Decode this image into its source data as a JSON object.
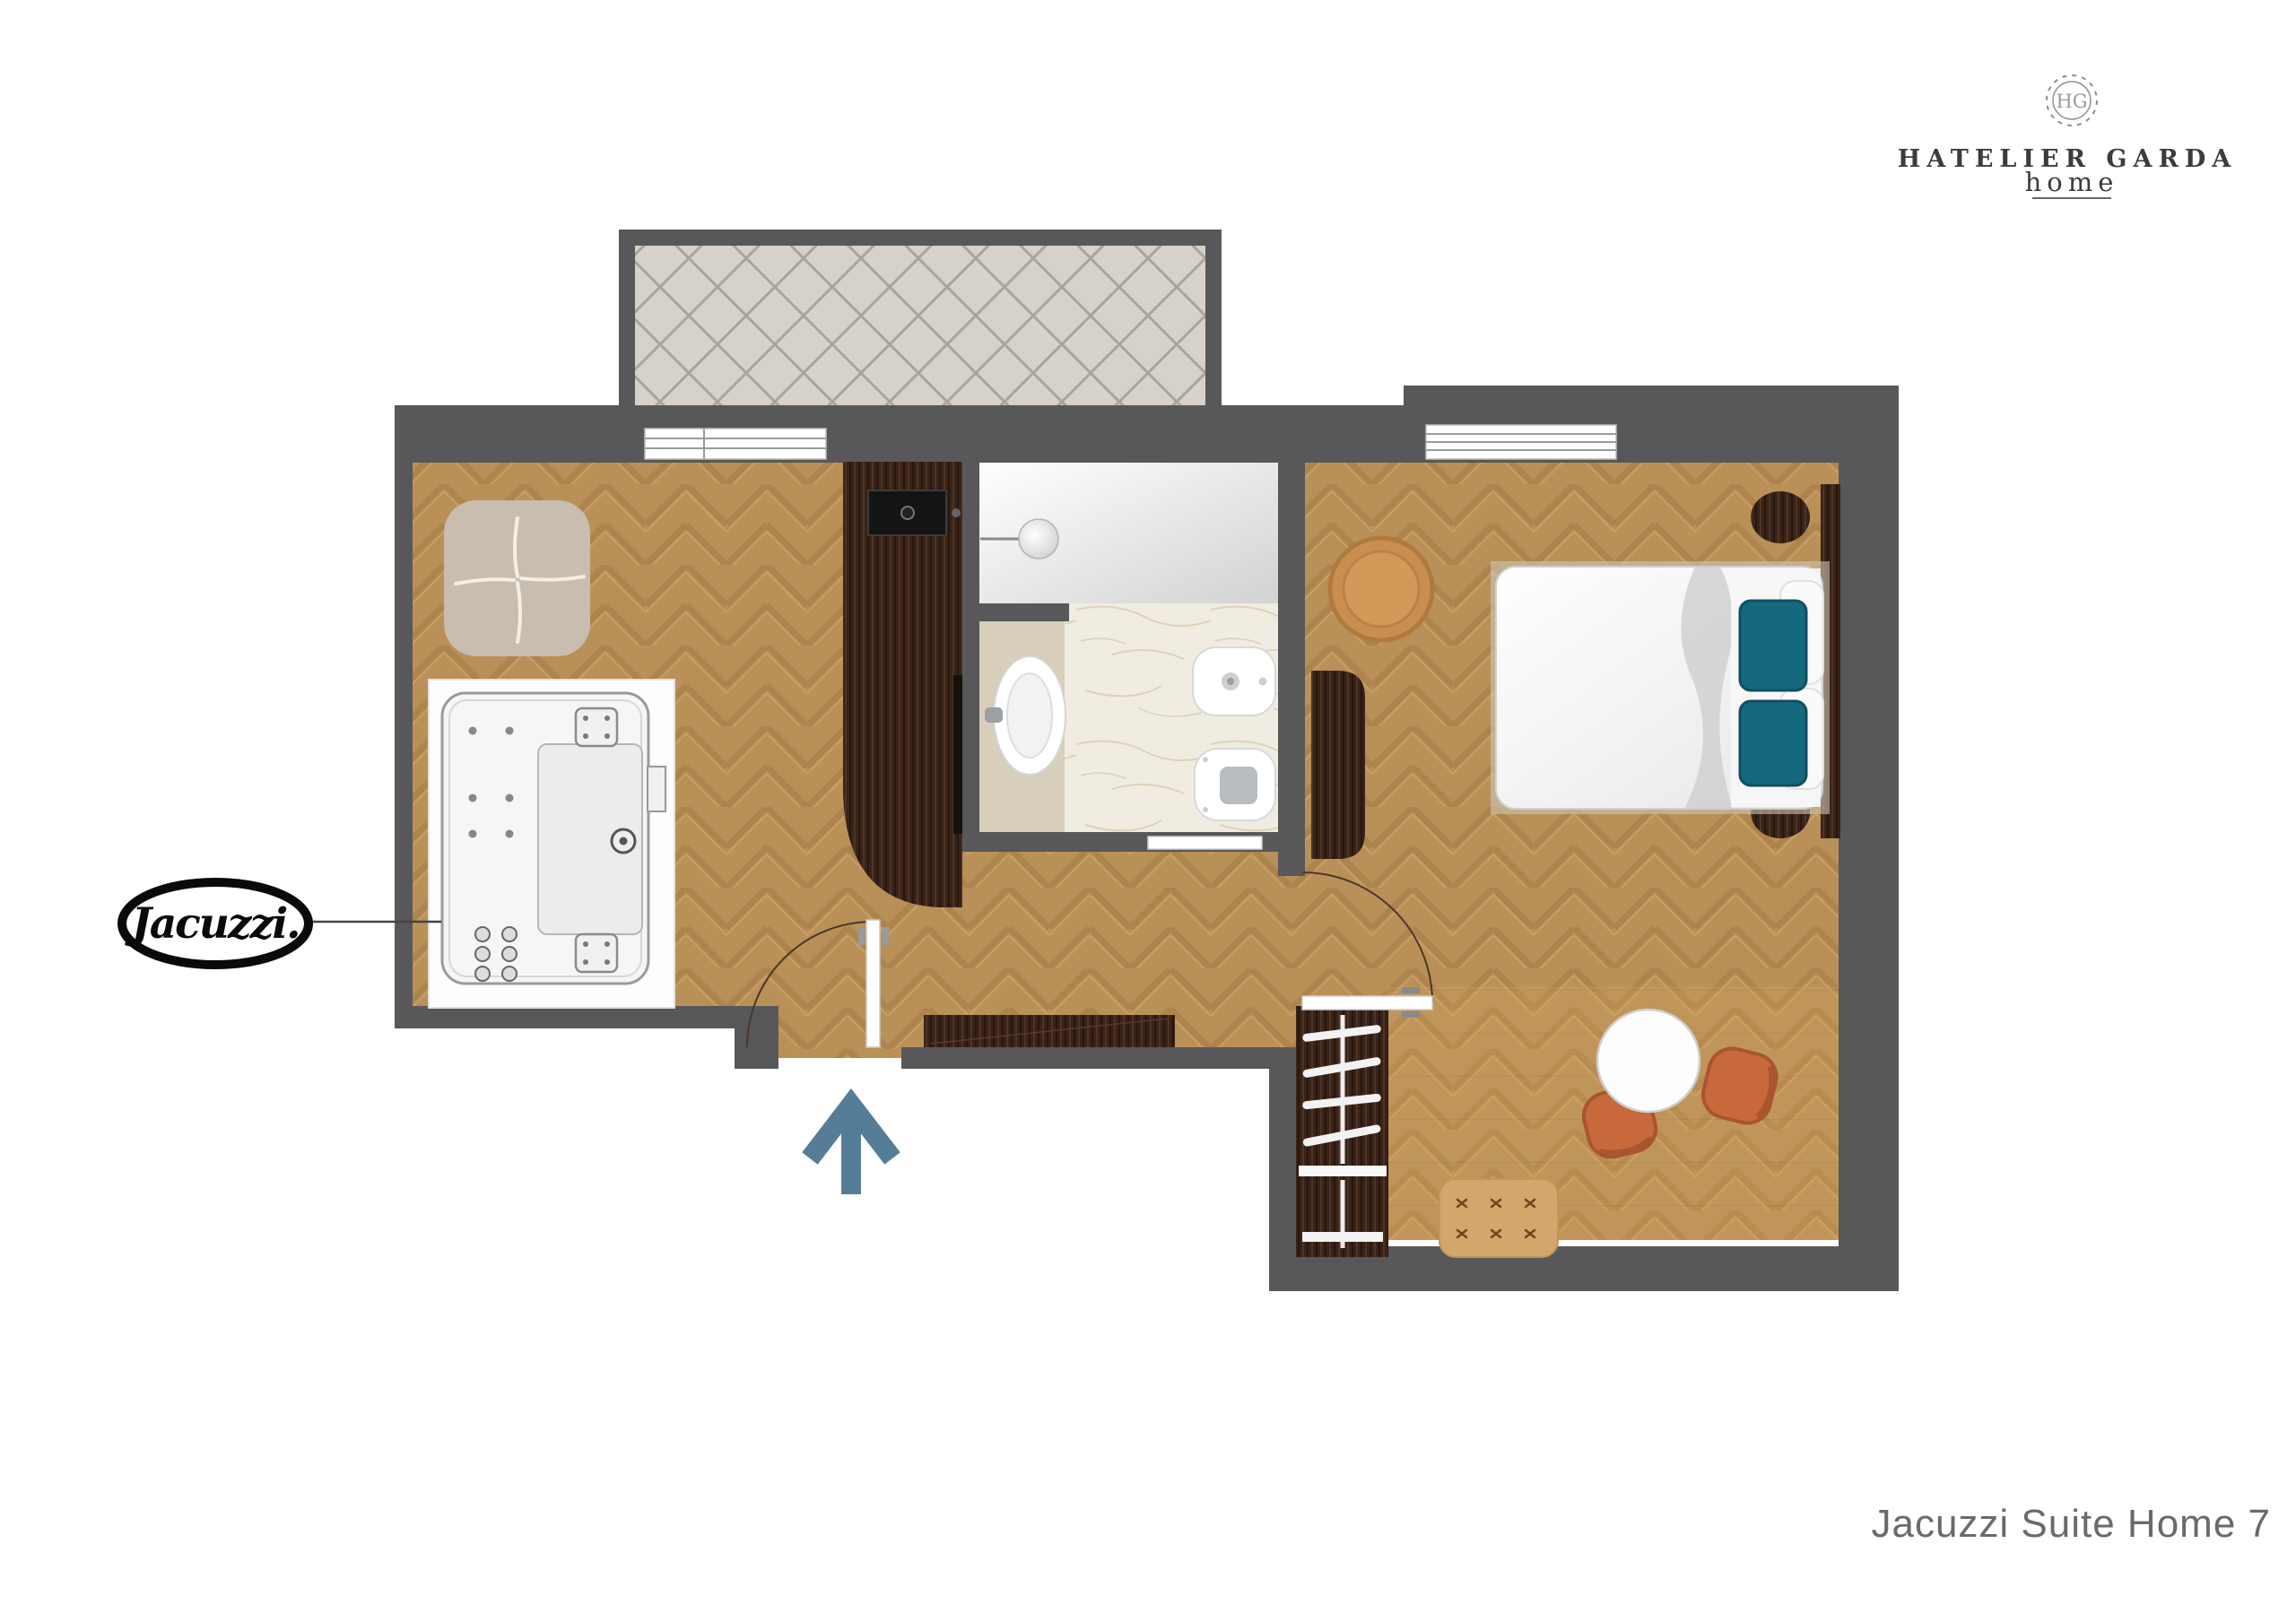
{
  "header_logo": {
    "monogram": "HG",
    "brand": "HATELIER GARDA",
    "sub": "home"
  },
  "plan_title": "Jacuzzi Suite Home 7",
  "jacuzzi_badge": "Jacuzzi.",
  "colors": {
    "wall": "#58585a",
    "wood": "#ba9059",
    "wood_dark": "#a17944",
    "wenge": "#38231a",
    "terrace_tile": "#d6d2ca",
    "marble": "#f1ece1",
    "vanity_counter": "#d7cebb",
    "pillow_teal": "#15687e",
    "chair_terracotta": "#c8693c",
    "bench_tan": "#d3a76b",
    "pouf_orange": "#c98f4f",
    "entry_arrow": "#567d98",
    "title_text": "#6a6a6a",
    "logo_text": "#3c3c40"
  }
}
